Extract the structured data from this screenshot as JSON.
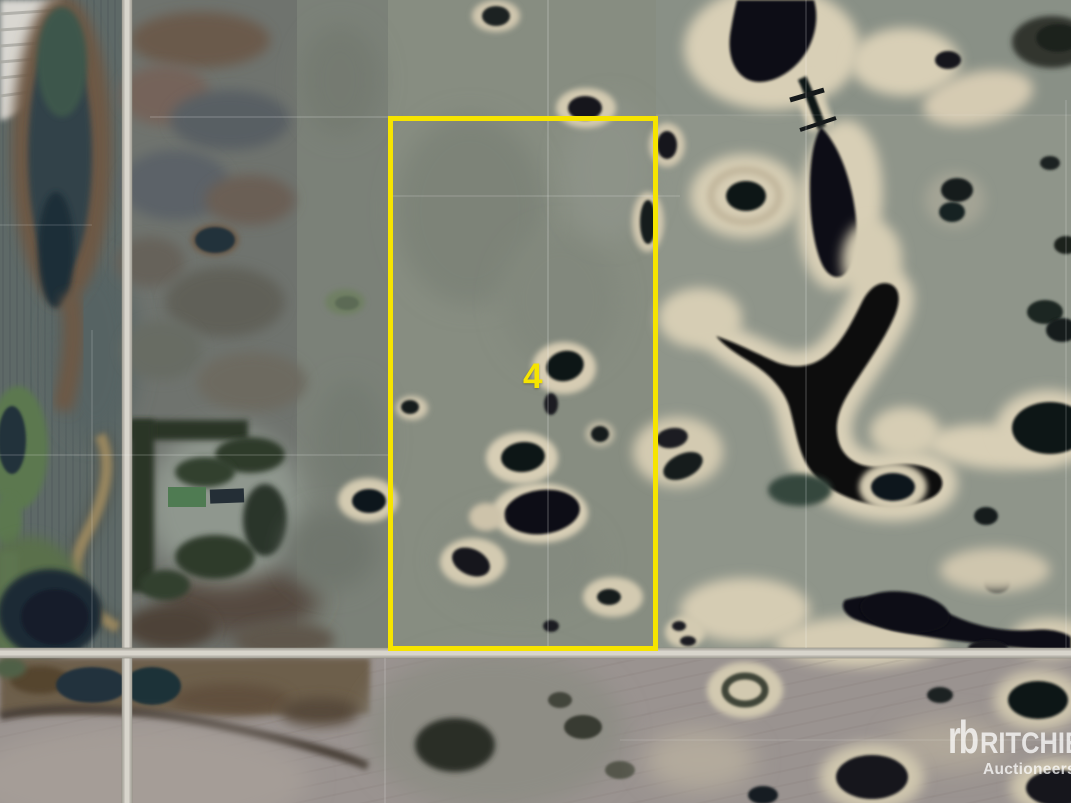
{
  "canvas": {
    "width": 1071,
    "height": 803
  },
  "parcel": {
    "label": "4",
    "outline_color": "#F6E400"
  },
  "watermark": {
    "logo": "rb",
    "brand": "RITCHIE",
    "subtitle": "Auctioneers",
    "color": "#FFFFFF"
  }
}
